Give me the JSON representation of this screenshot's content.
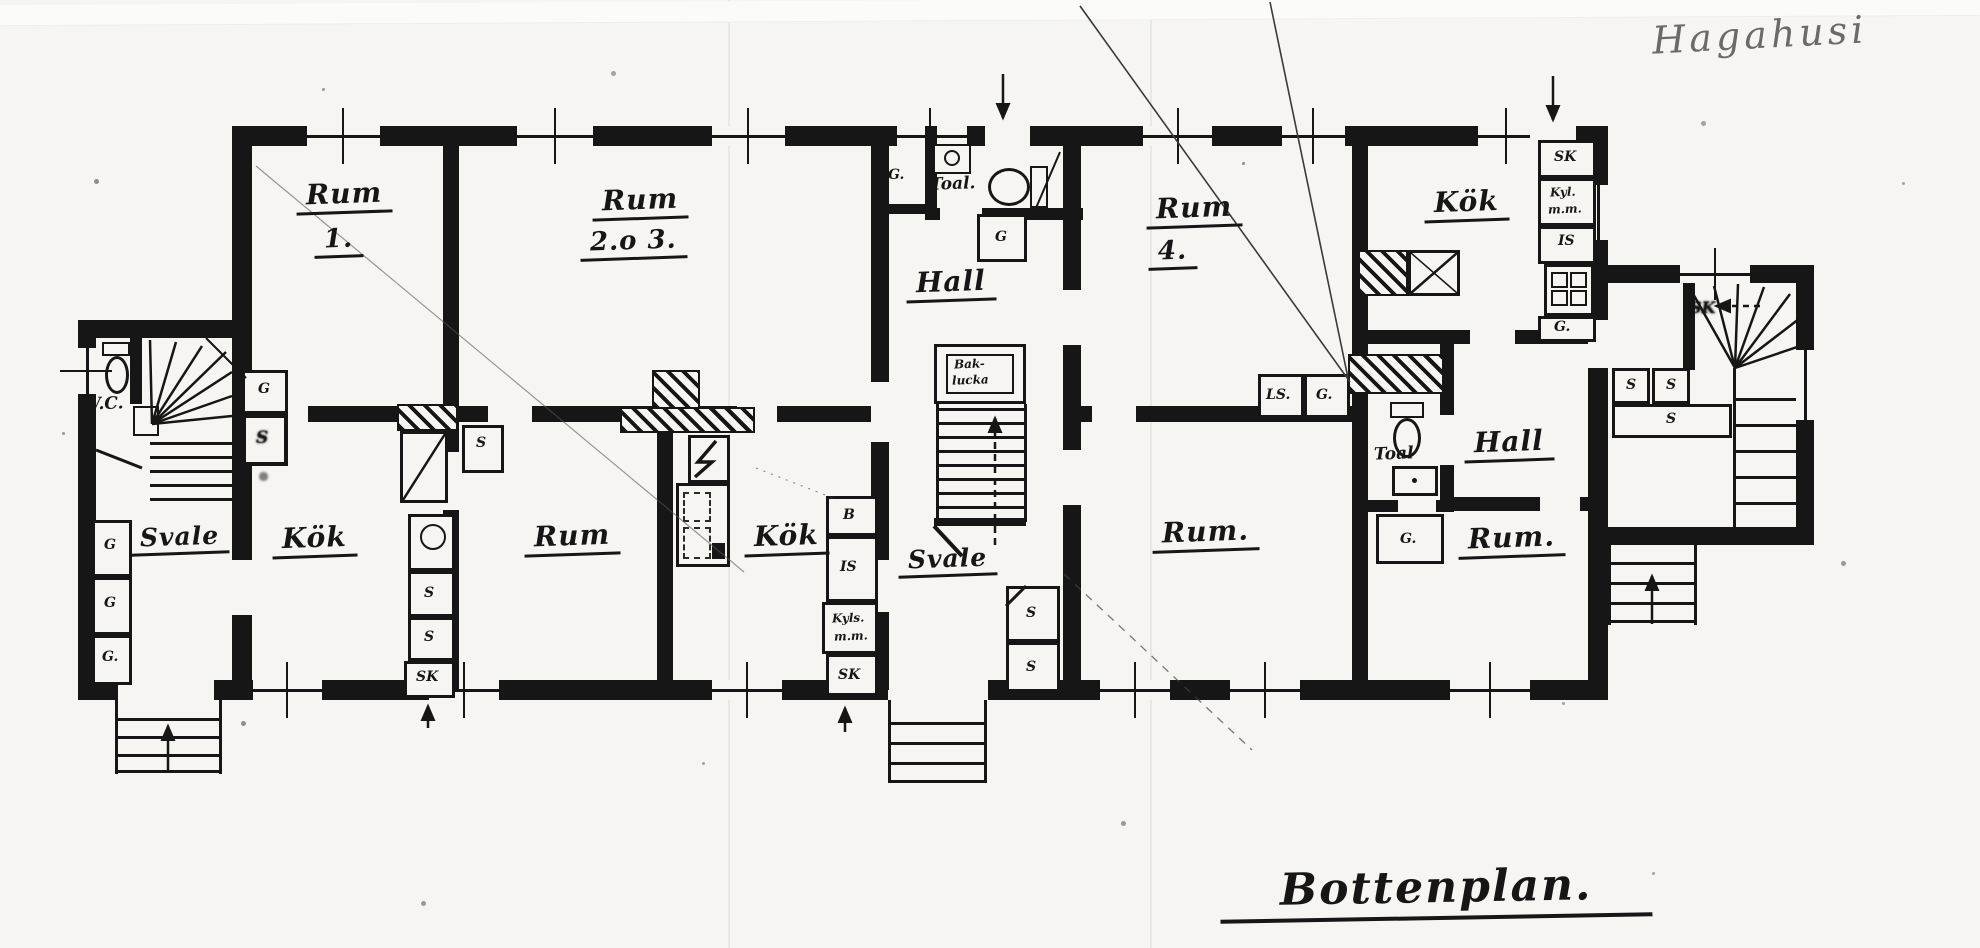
{
  "colors": {
    "ink": "#151616",
    "paper": "#f6f5f1",
    "pencil": "#6a6a6a"
  },
  "titles": {
    "handwriting": "Hagahusi",
    "caption": "Bottenplan."
  },
  "labels": {
    "rum1_1": "Rum",
    "rum1_2": "1.",
    "rum23_1": "Rum",
    "rum23_2": "2.o 3.",
    "rum4_1": "Rum",
    "rum4_2": "4.",
    "hall_center": "Hall",
    "hall_right": "Hall",
    "kok_left": "Kök",
    "kok_mid": "Kök",
    "kok_right": "Kök",
    "rum_mid": "Rum",
    "rum_bottom": "Rum.",
    "rum_right": "Rum.",
    "svale_left": "Svale",
    "svale_center": "Svale",
    "wc": "W.C.",
    "toal_top": "Toal.",
    "toal_right": "Toal",
    "baklucka_1": "Bak-",
    "baklucka_2": "lucka",
    "g_lobby": "G.",
    "g_under_toal": "G",
    "b": "B",
    "is_mid": "IS",
    "kyls_1": "Kyls.",
    "kyls_2": "m.m.",
    "sk_mid": "SK",
    "s_svale1": "S",
    "s_svale2": "S",
    "ls": "LS.",
    "g_rum4": "G.",
    "g_toal_right": "G.",
    "sk_kok": "SK",
    "kyl_1": "Kyl.",
    "kyl_2": "m.m.",
    "is_kok": "IS",
    "g_kok": "G.",
    "s_rum_mid": "S",
    "s_kokleft1": "S",
    "s_kokleft2": "S",
    "sk_kokleft": "SK",
    "g_stair": "G",
    "s_stair": "S",
    "g_col1": "G",
    "g_col2": "G",
    "g_col3": "G.",
    "sk_wing": "SK",
    "s_wing1": "S",
    "s_wing2": "S",
    "s_wing_wide": "S"
  }
}
